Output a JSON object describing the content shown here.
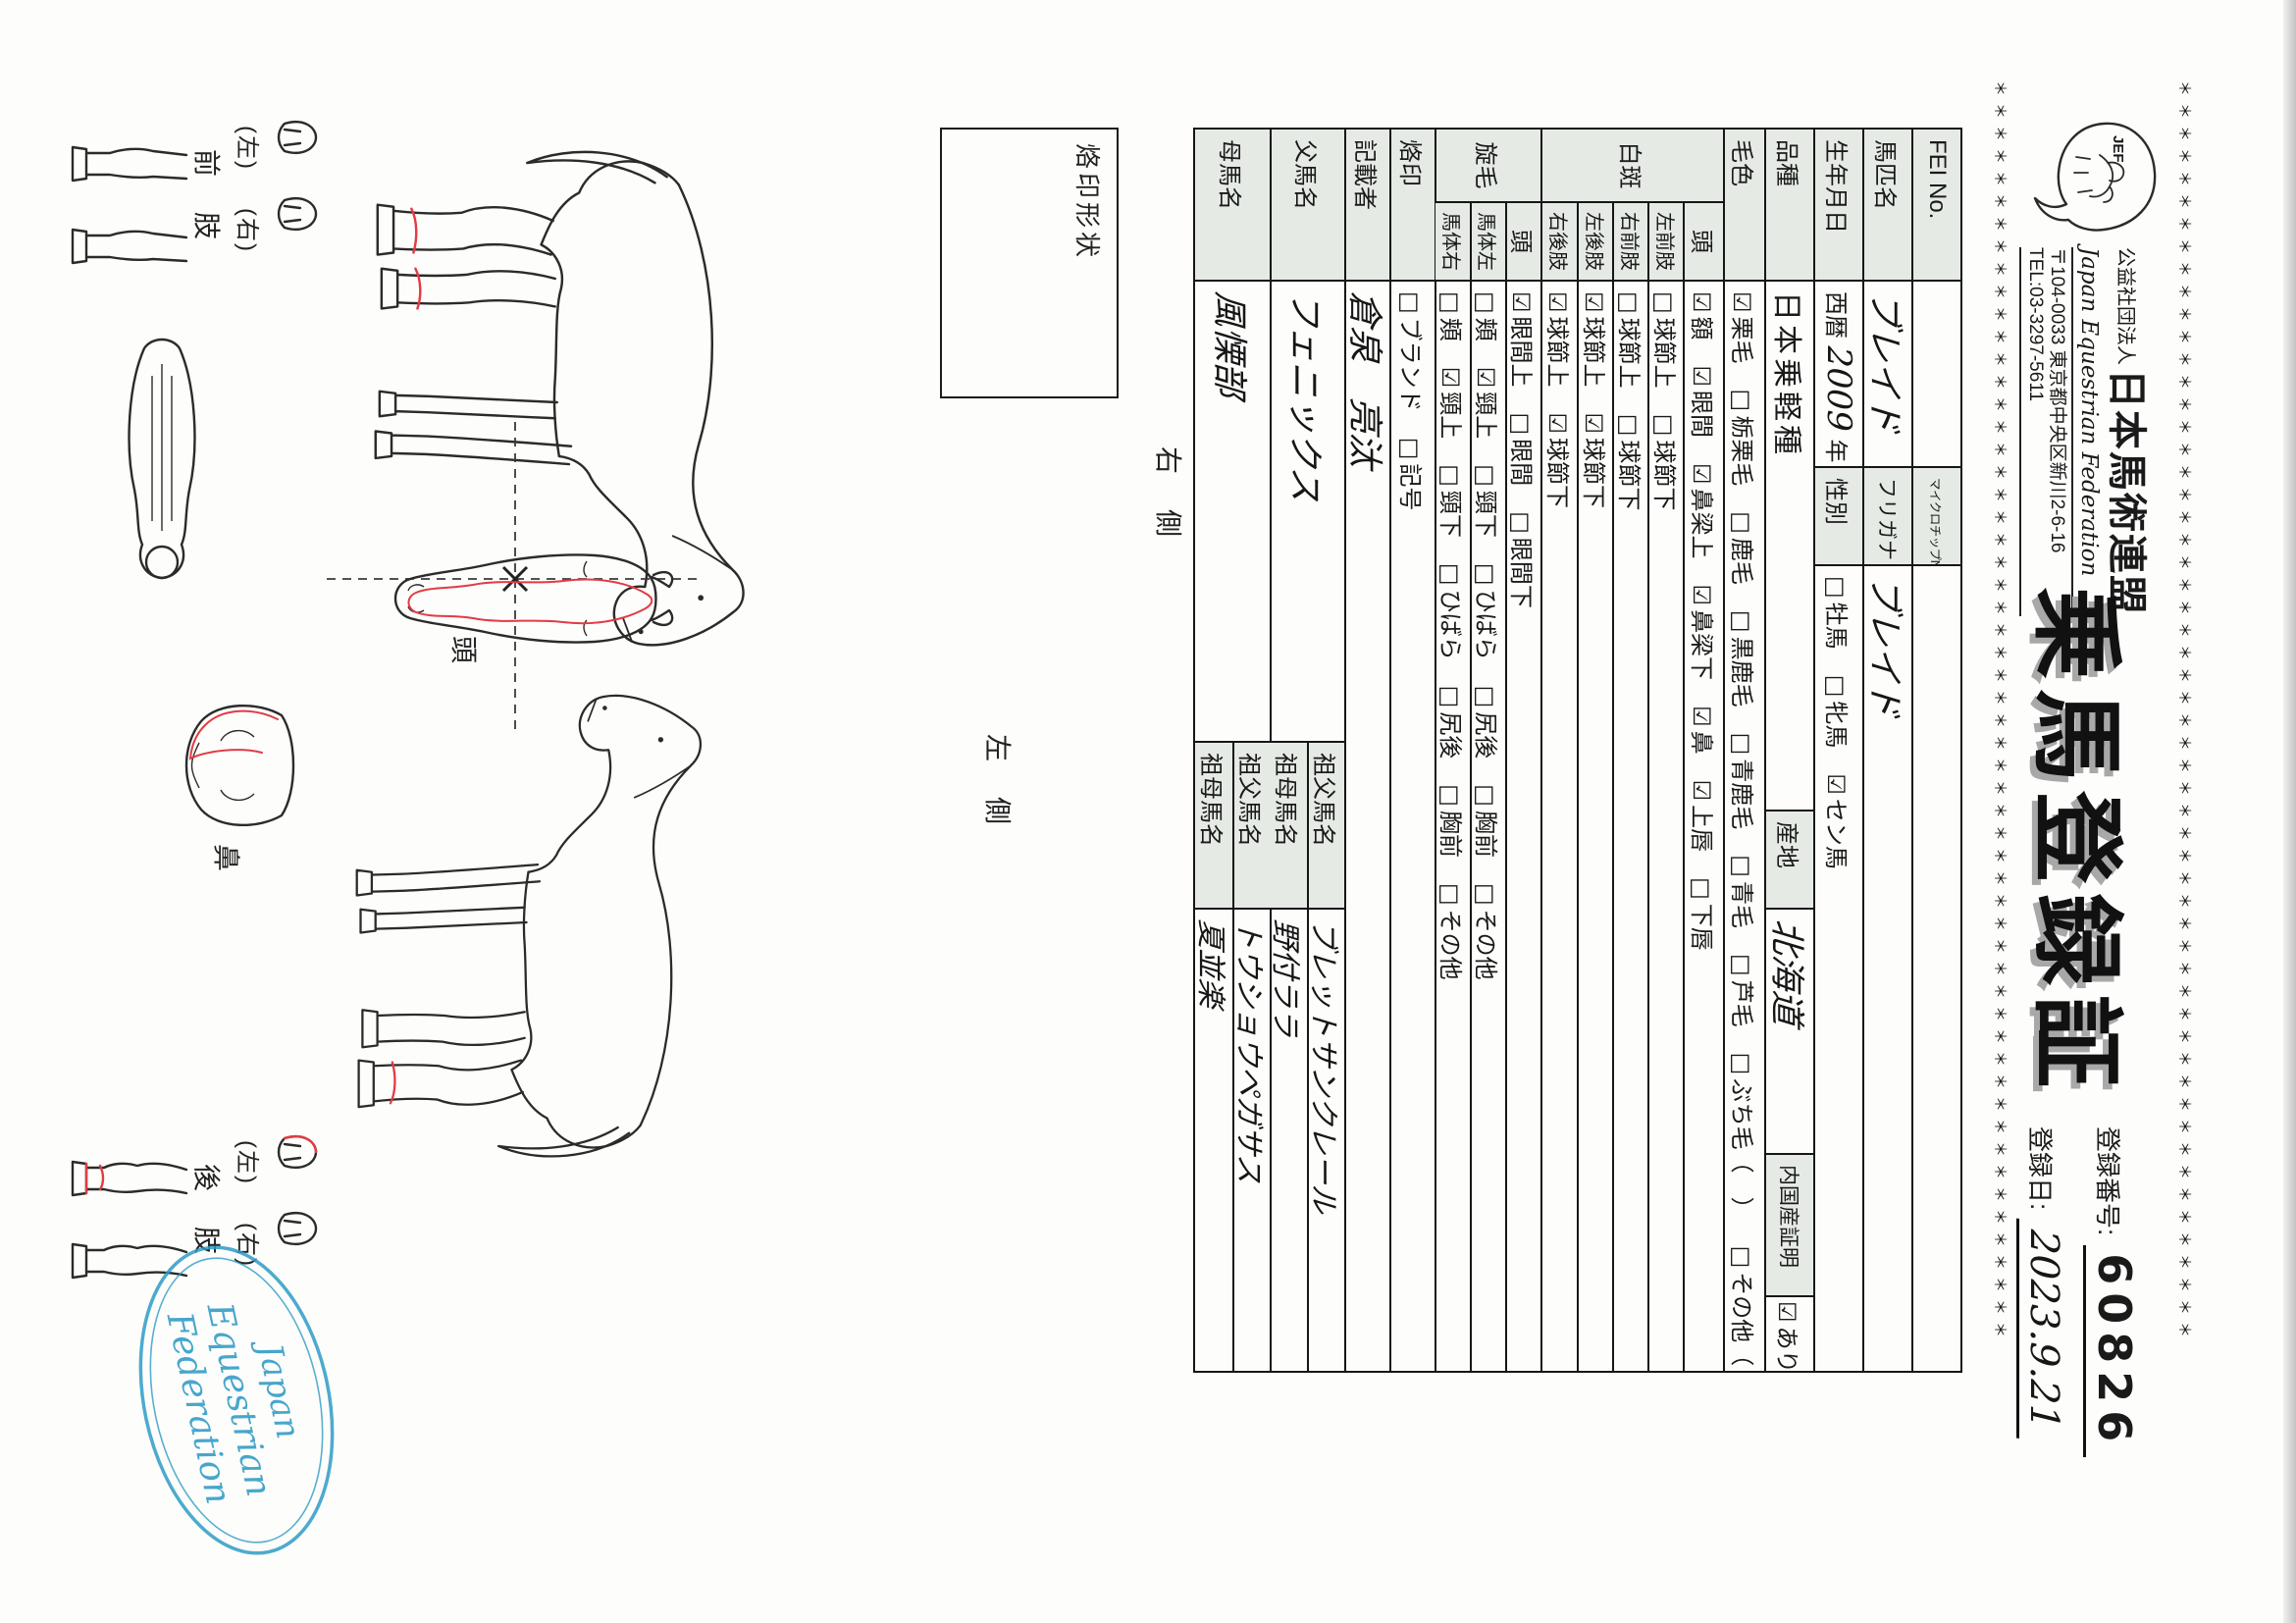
{
  "header": {
    "border_line": "＊＊＊＊＊＊＊＊＊＊＊＊＊＊＊＊＊＊＊＊＊＊＊＊＊＊＊＊＊＊＊＊＊＊＊＊＊＊＊＊＊＊＊＊＊＊＊＊＊＊＊＊＊＊＊＊",
    "logo_text": "JEF",
    "org_small": "公益社団法人",
    "org_name": "日本馬術連盟",
    "org_en": "Japan Equestrian Federation",
    "org_address": "〒104-0033 東京都中央区新川2-6-16",
    "org_tel": "TEL:03-3297-5611",
    "title": "乗馬登録証",
    "reg_no_label": "登録番号:",
    "reg_no": "60826",
    "reg_date_label": "登録日:",
    "reg_date": "2023.9.21"
  },
  "table": {
    "fei": {
      "label": "FEI No.",
      "value": "",
      "chip_label": "マイクロチップNo.",
      "chip_value": ""
    },
    "name": {
      "label": "馬匹名",
      "value": "ブレイド",
      "kana_label": "フリガナ",
      "kana_value": "ブレイド"
    },
    "birth": {
      "label": "生年月日",
      "era": "西暦",
      "year": "2009",
      "y_unit": "年",
      "month": "4",
      "m_unit": "月",
      "day": "18",
      "d_unit": "日",
      "born": "生",
      "sex_label": "性別",
      "sex_options": [
        {
          "box": "□",
          "label": "牡馬"
        },
        {
          "box": "□",
          "label": "牝馬"
        },
        {
          "box": "☑",
          "label": "セン馬"
        }
      ]
    },
    "breed": {
      "label": "品種",
      "value": "日本乗軽種",
      "origin_label": "産地",
      "origin_value": "北海道",
      "domestic_label": "内国産証明",
      "domestic_box": "☑",
      "domestic_value": "あり"
    },
    "coat": {
      "label": "毛色",
      "options": [
        {
          "box": "☑",
          "label": "栗毛"
        },
        {
          "box": "□",
          "label": "栃栗毛"
        },
        {
          "box": "□",
          "label": "鹿毛"
        },
        {
          "box": "□",
          "label": "黒鹿毛"
        },
        {
          "box": "□",
          "label": "青鹿毛"
        },
        {
          "box": "□",
          "label": "青毛"
        },
        {
          "box": "□",
          "label": "芦毛"
        },
        {
          "box": "□",
          "label": "ぶち毛（　）"
        },
        {
          "box": "□",
          "label": "その他（　）"
        }
      ]
    },
    "markings": {
      "label": "白斑",
      "rows": [
        {
          "label": "頭",
          "options": [
            {
              "box": "☑",
              "label": "額"
            },
            {
              "box": "☑",
              "label": "眼間"
            },
            {
              "box": "☑",
              "label": "鼻梁上"
            },
            {
              "box": "☑",
              "label": "鼻梁下"
            },
            {
              "box": "☑",
              "label": "鼻"
            },
            {
              "box": "☑",
              "label": "上唇"
            },
            {
              "box": "□",
              "label": "下唇"
            }
          ]
        },
        {
          "label": "左前肢",
          "options": [
            {
              "box": "□",
              "label": "球節上"
            },
            {
              "box": "□",
              "label": "球節下"
            }
          ]
        },
        {
          "label": "右前肢",
          "options": [
            {
              "box": "□",
              "label": "球節上"
            },
            {
              "box": "□",
              "label": "球節下"
            }
          ]
        },
        {
          "label": "左後肢",
          "options": [
            {
              "box": "☑",
              "label": "球節上"
            },
            {
              "box": "☑",
              "label": "球節下"
            }
          ]
        },
        {
          "label": "右後肢",
          "options": [
            {
              "box": "☑",
              "label": "球節上"
            },
            {
              "box": "☑",
              "label": "球節下"
            }
          ]
        }
      ]
    },
    "whorls": {
      "label": "旋毛",
      "rows": [
        {
          "label": "頭",
          "options": [
            {
              "box": "☑",
              "label": "眼間上"
            },
            {
              "box": "□",
              "label": "眼間"
            },
            {
              "box": "□",
              "label": "眼間下"
            }
          ]
        },
        {
          "label": "馬体左",
          "options": [
            {
              "box": "□",
              "label": "頬"
            },
            {
              "box": "☑",
              "label": "頸上"
            },
            {
              "box": "□",
              "label": "頸下"
            },
            {
              "box": "□",
              "label": "ひばら"
            },
            {
              "box": "□",
              "label": "尻後"
            },
            {
              "box": "□",
              "label": "胸前"
            },
            {
              "box": "□",
              "label": "その他"
            }
          ]
        },
        {
          "label": "馬体右",
          "options": [
            {
              "box": "□",
              "label": "頬"
            },
            {
              "box": "☑",
              "label": "頸上"
            },
            {
              "box": "□",
              "label": "頸下"
            },
            {
              "box": "□",
              "label": "ひばら"
            },
            {
              "box": "□",
              "label": "尻後"
            },
            {
              "box": "□",
              "label": "胸前"
            },
            {
              "box": "□",
              "label": "その他"
            }
          ]
        }
      ]
    },
    "brand": {
      "label": "烙印",
      "options": [
        {
          "box": "□",
          "label": "ブランド"
        },
        {
          "box": "□",
          "label": "記号"
        }
      ]
    },
    "recorder": {
      "label": "記載者",
      "value": "倉泉　亮汰"
    },
    "sire": {
      "label": "父馬名",
      "value": "フェニックス",
      "gsire_label": "祖父馬名",
      "gsire_value": "ブレットサンクレール",
      "gdam_label": "祖母馬名",
      "gdam_value": "野付ララ"
    },
    "dam": {
      "label": "母馬名",
      "value": "風慄部",
      "gsire_label": "祖父馬名",
      "gsire_value": "トウショウペガサス",
      "gdam_label": "祖母馬名",
      "gdam_value": "夏並楽"
    }
  },
  "diagram": {
    "brand_shape_label": "烙印形状",
    "right_side_label": "右　側",
    "left_side_label": "左　側",
    "head_label": "頭",
    "nose_label": "鼻",
    "front_limbs_label": "前　肢",
    "hind_limbs_label": "後　肢",
    "left_paren": "(左)",
    "right_paren": "(右)",
    "stamp": {
      "line1": "Japan",
      "line2": "Equestrian",
      "line3": "Federation"
    }
  },
  "colors": {
    "cell_shade": "#e5eae5",
    "marking_red": "#e23b44",
    "stamp_blue": "#2e9bc6",
    "title_shadow": "#a8a8a8"
  }
}
